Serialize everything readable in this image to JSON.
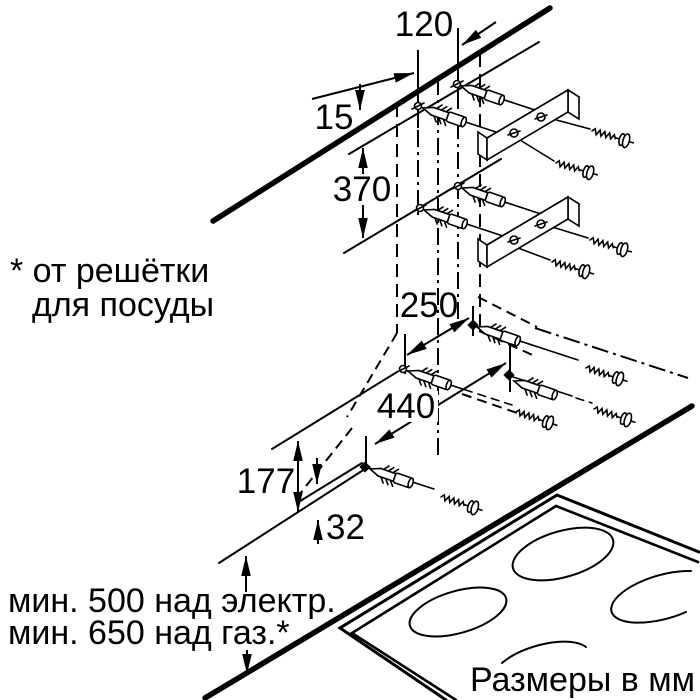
{
  "title": "Схема монтажа вытяжки",
  "dimensions_mm": {
    "duct_offset": "120",
    "ceiling_gap": "15",
    "upper_hole_drop": "370",
    "mid_hole_spacing": "250",
    "lower_hole_spacing": "440",
    "body_height": "177",
    "bottom_lip": "32"
  },
  "notes": {
    "asterisk_line1": "* от решётки",
    "asterisk_line2": "для посуды",
    "min_clearance_electric": "мин. 500 над электр.",
    "min_clearance_gas": "мин. 650 над газ.*",
    "units": "Размеры в мм"
  },
  "parts": {
    "wall": "стена",
    "hood_outline": "вытяжка (пунктир)",
    "anchor": "дюбель",
    "screw": "шуруп",
    "bracket": "монтажная планка",
    "cooktop": "варочная панель"
  },
  "colors": {
    "ink": "#000000",
    "paper": "#ffffff"
  }
}
